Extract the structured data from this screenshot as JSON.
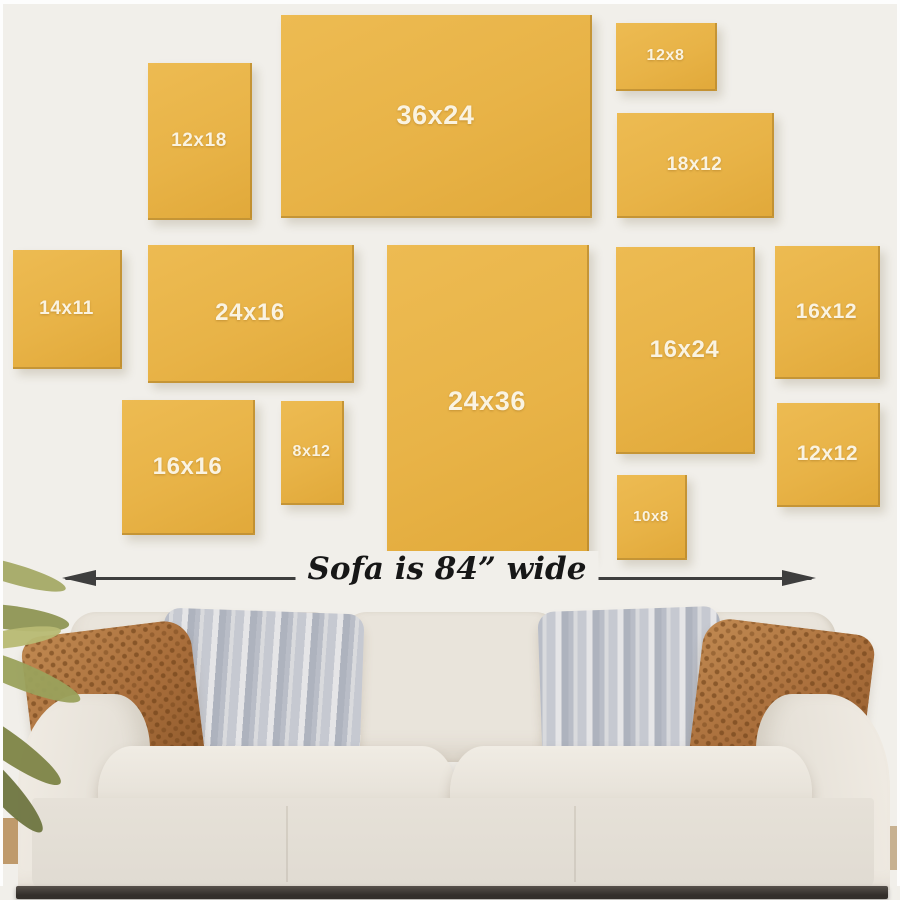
{
  "size_guide": {
    "frames": [
      {
        "label": "12x18"
      },
      {
        "label": "36x24"
      },
      {
        "label": "12x8"
      },
      {
        "label": "18x12"
      },
      {
        "label": "14x11"
      },
      {
        "label": "24x16"
      },
      {
        "label": "24x36"
      },
      {
        "label": "16x24"
      },
      {
        "label": "16x12"
      },
      {
        "label": "16x16"
      },
      {
        "label": "8x12"
      },
      {
        "label": "10x8"
      },
      {
        "label": "12x12"
      }
    ]
  },
  "measurement": {
    "label": "Sofa is 84” wide",
    "left_icon": "arrow-left-icon",
    "right_icon": "arrow-right-icon"
  },
  "colors": {
    "frame_gold": "#e8b347",
    "frame_edge": "#9e701c",
    "wall": "#f1efea",
    "arrow": "#3e3e3e",
    "frame_label_text": "#faf3e1",
    "sofa_fabric": "#e7e2d9",
    "pillow_brown": "#a96e3b",
    "pillow_gray": "#c6c9d1",
    "plant_olive": "#8e9554"
  }
}
